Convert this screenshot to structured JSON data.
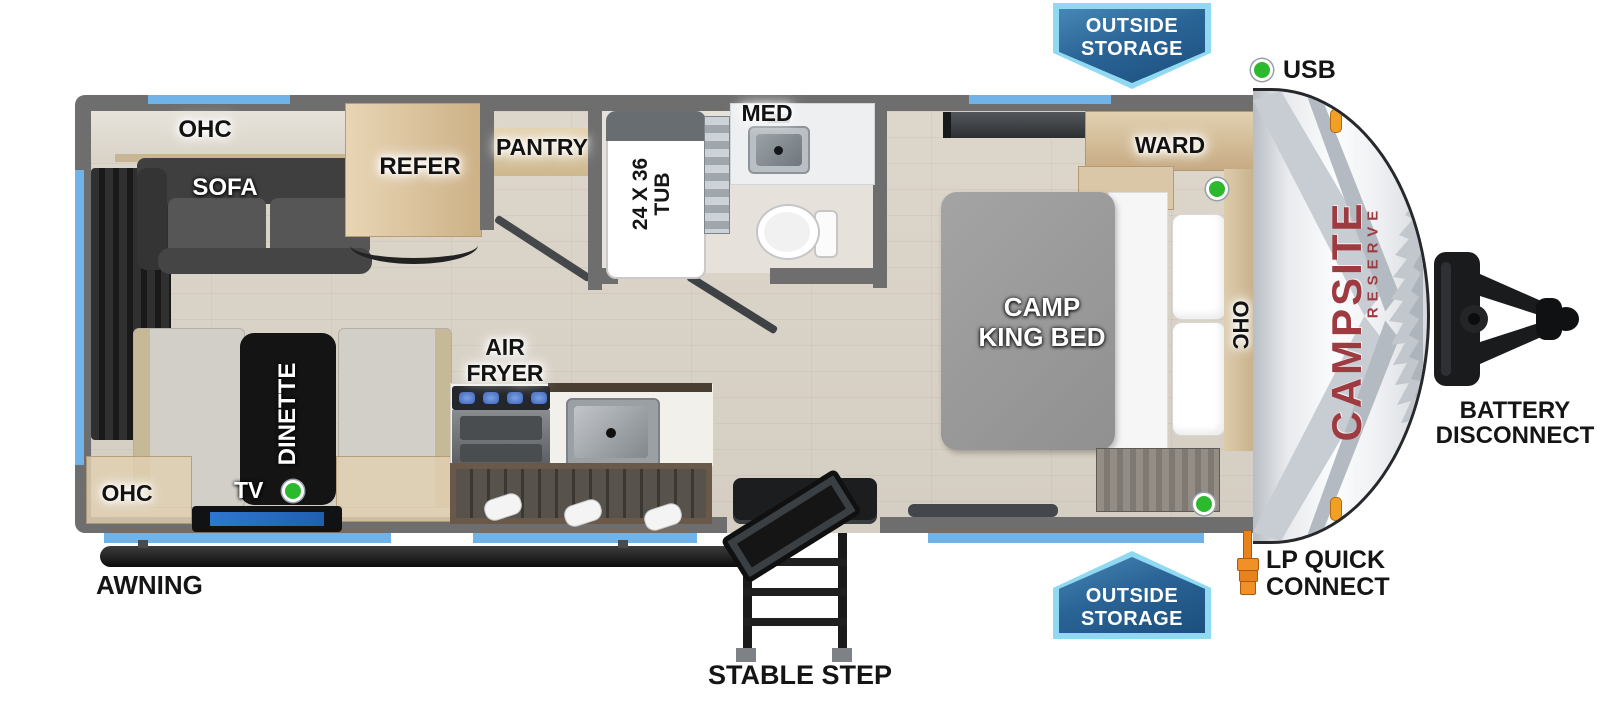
{
  "brand": {
    "name": "CAMPSITE",
    "series": "RESERVE"
  },
  "badges": {
    "top": {
      "line1": "OUTSIDE",
      "line2": "STORAGE"
    },
    "bottom": {
      "line1": "OUTSIDE",
      "line2": "STORAGE"
    }
  },
  "callouts": {
    "usb": "USB",
    "battery_line1": "BATTERY",
    "battery_line2": "DISCONNECT",
    "lp_line1": "LP QUICK",
    "lp_line2": "CONNECT",
    "awning": "AWNING",
    "stable_step": "STABLE STEP"
  },
  "labels": {
    "ohc_top": "OHC",
    "sofa": "SOFA",
    "refer": "REFER",
    "pantry": "PANTRY",
    "med": "MED",
    "tub_line1": "24 X 36",
    "tub_line2": "TUB",
    "ward": "WARD",
    "bed_line1": "CAMP",
    "bed_line2": "KING BED",
    "ohc_bed": "OHC",
    "air_line1": "AIR",
    "air_line2": "FRYER",
    "dinette": "DINETTE",
    "tv": "TV",
    "ohc_dinette": "OHC"
  },
  "colors": {
    "wall_gray": "#6e6e6e",
    "window_blue": "#6fb3e8",
    "badge_blue": "#1b4f7e",
    "badge_border": "#8fd9f2",
    "indicator_green": "#2db92d",
    "brand_maroon": "#9e3b40",
    "lp_orange": "#e8821c"
  }
}
